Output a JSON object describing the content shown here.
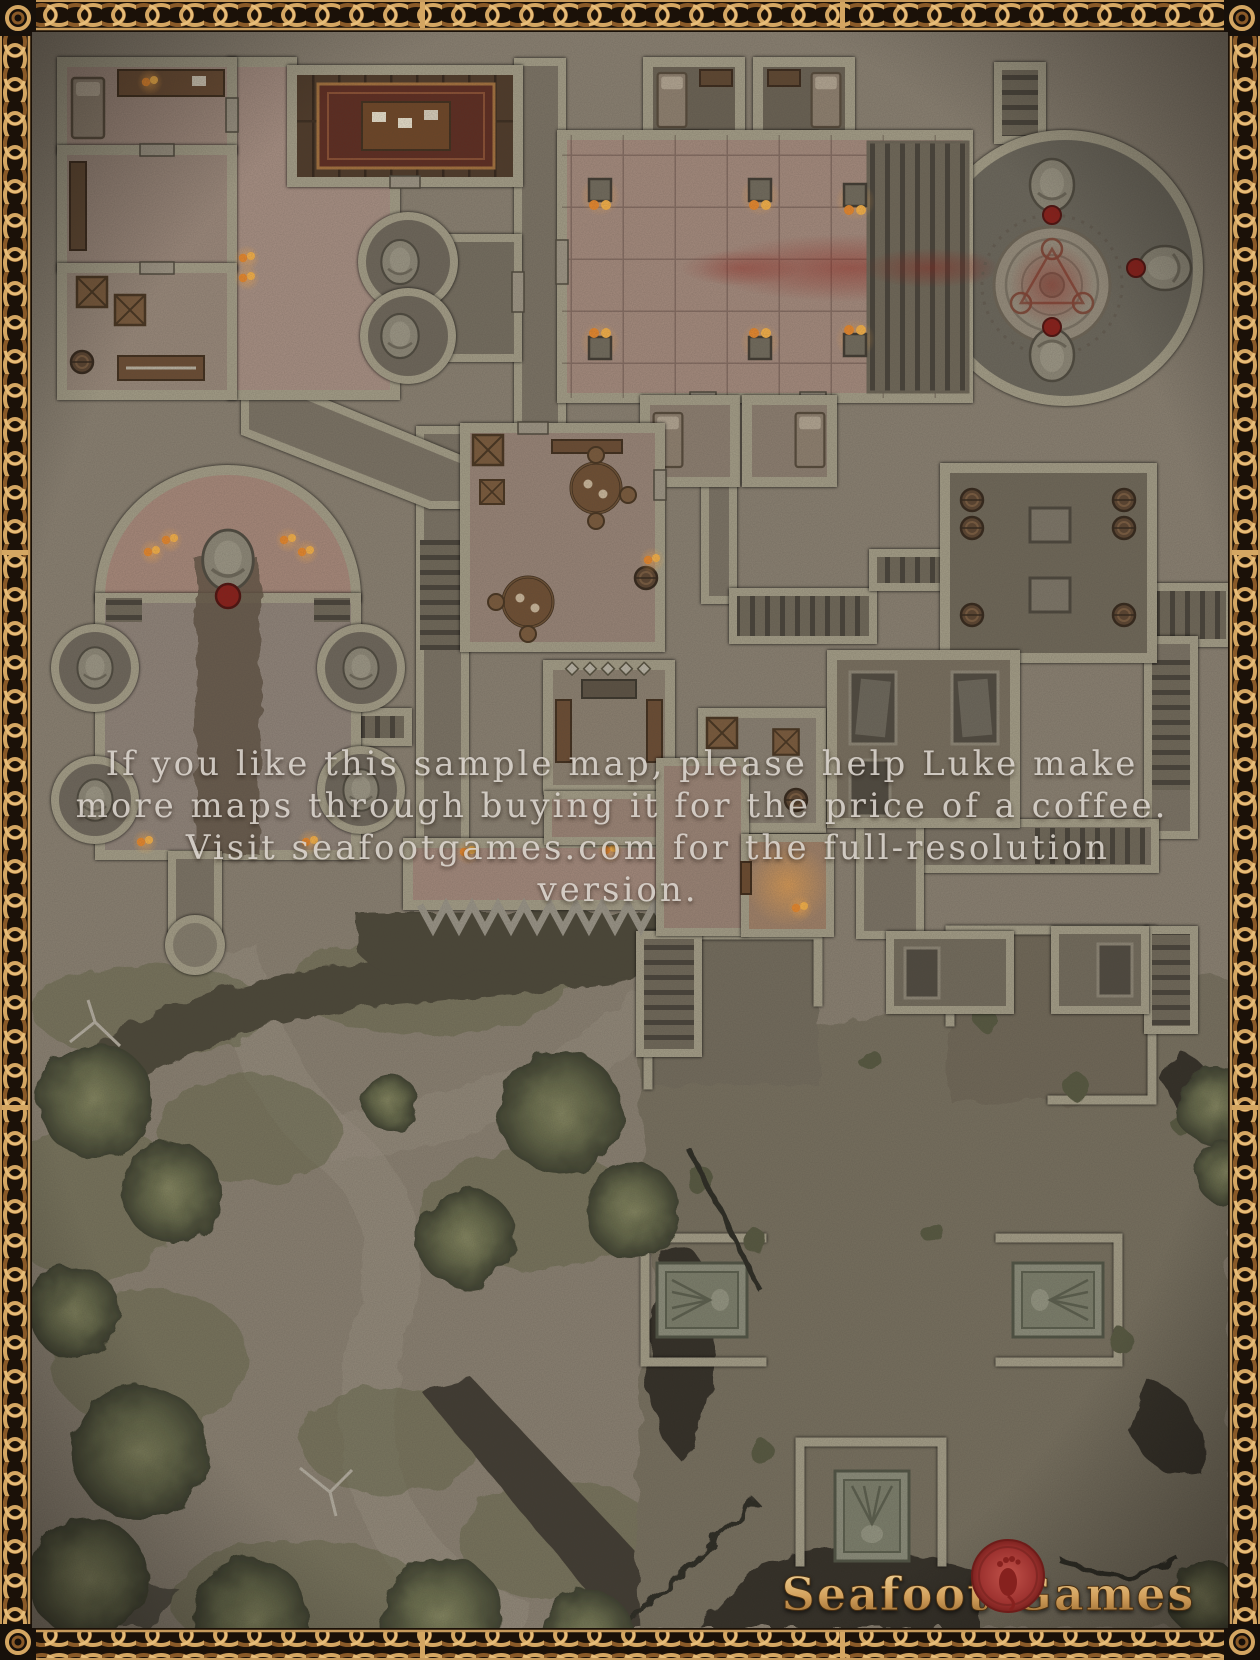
{
  "overlay": {
    "lines": [
      "If you like this sample map, please help Luke make",
      "more maps through buying it for the price of a coffee.",
      "Visit seafootgames.com for the full-resolution",
      "version."
    ],
    "text_color": "#dcd6cf"
  },
  "logo": {
    "word_left": "Seafoot",
    "word_right": "Games",
    "seal_icon": "footprint-wax-seal",
    "gold_color": "#d7ae6c",
    "seal_color": "#a23531"
  },
  "palette": {
    "frame_gold": "#cf9f5f",
    "frame_dark": "#1b1108",
    "ground_stone": "#8a8172",
    "wall_stone": "#a49e88",
    "temple_floor": "#a58b7e",
    "corridor_floor": "#7b7365",
    "cave_floor": "#77705f",
    "wood_brown": "#6b4c33",
    "foliage_green": "#5f6146",
    "cliff_rock": "#45413a",
    "blood_red": "#8f231c",
    "flame_orange": "#f29b35"
  },
  "features": [
    "celtic-knot-border",
    "great-hall",
    "ritual-circle",
    "blood-trail",
    "braziers",
    "summoning-rotunda",
    "guardian-statues",
    "chapel",
    "side-apses",
    "bedroom",
    "study-carpet",
    "storage-crates",
    "barrel-cellar",
    "dining-hall",
    "shrine-benches",
    "crypt-niches",
    "palisade-spikes",
    "watchtower",
    "forest",
    "cliffs",
    "cave-crypt",
    "sarcophagi",
    "wax-seal-logo"
  ]
}
